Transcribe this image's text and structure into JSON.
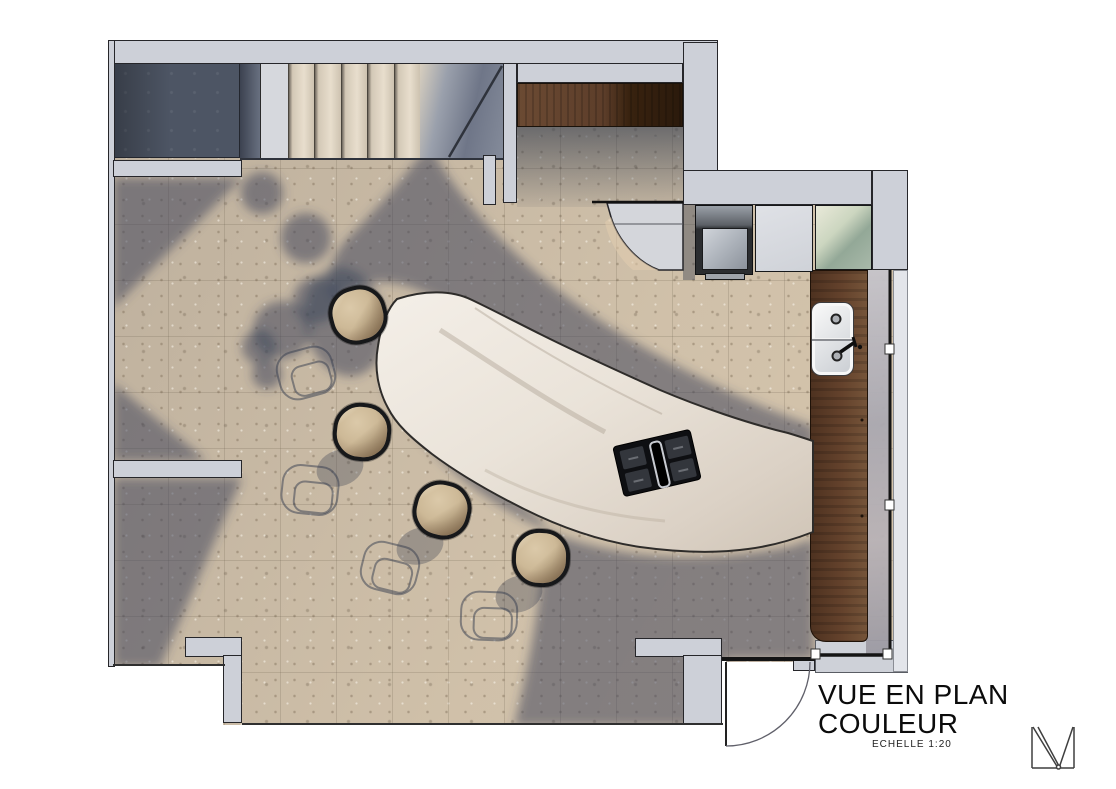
{
  "annotation": {
    "title_line1": "VUE EN PLAN",
    "title_line2": "COULEUR",
    "scale_label": "ECHELLE 1:20"
  },
  "logo": {
    "name": "architect-monogram-m"
  },
  "drawing": {
    "type": "kitchen-floor-plan-color-render",
    "fixtures": [
      "staircase",
      "curved-marble-island",
      "induction-cooktop",
      "double-bowl-sink",
      "bar-stool",
      "bar-stool",
      "bar-stool",
      "bar-stool",
      "wood-wall-cabinet",
      "wood-window-counter",
      "oven",
      "tall-cabinet",
      "glass-front-cabinet",
      "curved-corner-counter",
      "entry-door-swing",
      "window-wall"
    ],
    "stool_count": 4,
    "palette": {
      "floor_lit": "#c7b7a0",
      "floor_shadow": "#6f7787",
      "wall": "#cdd0d8",
      "wood_dark": "#2b1a0c",
      "wood_counter": "#64422c",
      "marble": "#efe9e0",
      "stair_tread": "#e8decd",
      "glass_green": "#93a897",
      "line": "#141414"
    }
  }
}
